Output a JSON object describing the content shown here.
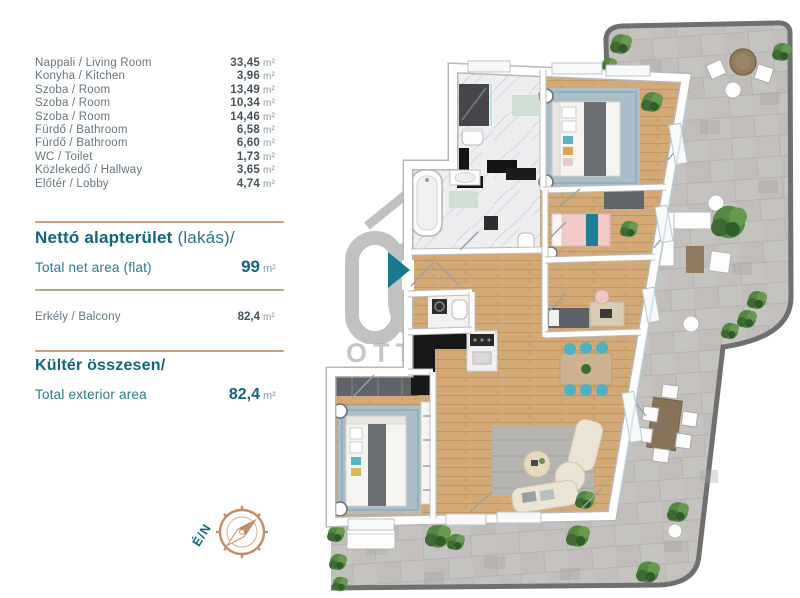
{
  "panel": {
    "unit": "m²",
    "rooms": [
      {
        "label": "Nappali / Living Room",
        "value": "33,45"
      },
      {
        "label": "Konyha / Kitchen",
        "value": "3,96"
      },
      {
        "label": "Szoba / Room",
        "value": "13,49"
      },
      {
        "label": "Szoba / Room",
        "value": "10,34"
      },
      {
        "label": "Szoba / Room",
        "value": "14,46"
      },
      {
        "label": "Fürdő / Bathroom",
        "value": "6,58"
      },
      {
        "label": "Fürdő / Bathroom",
        "value": "6,60"
      },
      {
        "label": "WC / Toilet",
        "value": "1,73"
      },
      {
        "label": "Közlekedő / Hallway",
        "value": "3,65"
      },
      {
        "label": "Előtér / Lobby",
        "value": "4,74"
      }
    ],
    "net": {
      "title_hu": "Nettó alapterület",
      "title_suffix": " (lakás)/",
      "label_en": "Total net area (flat)",
      "value": "99",
      "unit": "m²"
    },
    "balcony": {
      "label": "Erkély / Balcony",
      "value": "82,4",
      "unit": "m²"
    },
    "exterior": {
      "title_hu": "Kültér összesen/",
      "label_en": "Total exterior area",
      "value": "82,4",
      "unit": "m²"
    },
    "compass_label": "É/N"
  },
  "watermark": {
    "line1": "OTTHON",
    "line2": "CENTRUM"
  },
  "colors": {
    "teal": "#13657c",
    "tan_divider": "#c89d7b",
    "compass_tan": "#bf8e68",
    "wood": "#d2a977",
    "pavers": "#c5c3c0",
    "terrace_border": "#6f6f6f",
    "marble": "#eeeef1",
    "rug_blue": "#a9bec9",
    "accent_teal_chairs": "#4db3c4"
  }
}
